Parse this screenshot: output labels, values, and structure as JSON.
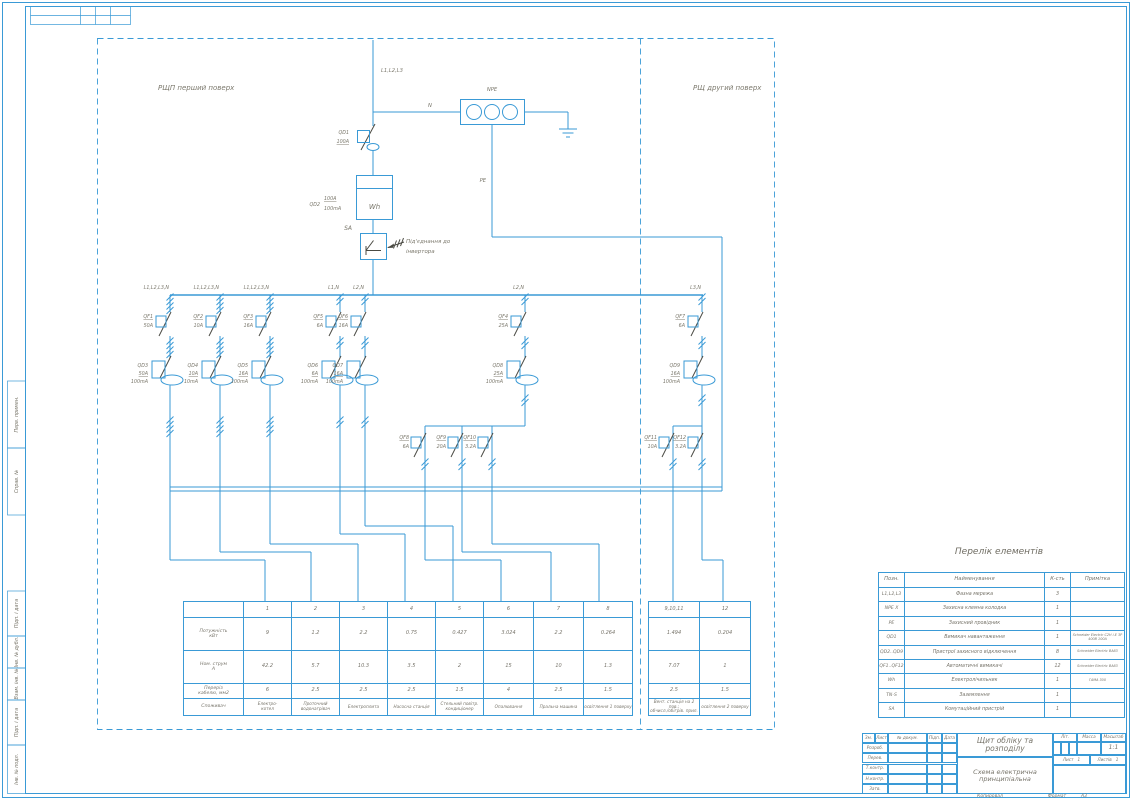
{
  "page": {
    "accent_color": "#3a9ad6",
    "symbol_color": "#4a4a43",
    "label_color": "#7b786c"
  },
  "frame": {
    "copied_label": "Копировал",
    "format_label": "Формат",
    "format_value": "А3",
    "left_stamps": [
      "Перв. примен.",
      "Справ. №",
      "Підп. і дата",
      "Інв. № дубл.",
      "Взам. інв. №",
      "Підп. і дата",
      "Інв. № подл."
    ]
  },
  "panels": {
    "first": "РЩП перший поверх",
    "second": "РЩ другий поверх"
  },
  "incoming": {
    "phase": "L1,L2,L3",
    "neutral": "N",
    "npe": "NPE",
    "pe": "PE",
    "qd1_name": "QD1",
    "qd1_rating": "100A",
    "meter_name": "QD2",
    "meter_rating": "100A",
    "meter_leak": "100mA",
    "meter_symbol": "Wh",
    "sa_name": "SA",
    "inverter_note_1": "Під'єднання до",
    "inverter_note_2": "інвертора"
  },
  "branches": [
    {
      "feed": "L1,L2,L3,N",
      "qf": "QF1",
      "qf_a": "50A",
      "qd": "QD3",
      "qd_a": "50A",
      "qd_ma": "100mA"
    },
    {
      "feed": "L1,L2,L3,N",
      "qf": "QF2",
      "qf_a": "10A",
      "qd": "QD4",
      "qd_a": "10A",
      "qd_ma": "10mA"
    },
    {
      "feed": "L1,L2,L3,N",
      "qf": "QF3",
      "qf_a": "16A",
      "qd": "QD5",
      "qd_a": "16A",
      "qd_ma": "100mA"
    },
    {
      "feed": "L1,N",
      "qf": "QF5",
      "qf_a": "6A",
      "qd": "QD6",
      "qd_a": "6A",
      "qd_ma": "100mA"
    },
    {
      "feed": "L2,N",
      "qf": "QF6",
      "qf_a": "16A",
      "qd": "QD7",
      "qd_a": "16A",
      "qd_ma": "100mA"
    },
    {
      "feed": "L2,N",
      "qf": "QF4",
      "qf_a": "25A",
      "qd": "QD8",
      "qd_a": "25A",
      "qd_ma": "100mA",
      "subs": [
        {
          "qf": "QF8",
          "qf_a": "6A"
        },
        {
          "qf": "QF9",
          "qf_a": "20A"
        },
        {
          "qf": "QF10",
          "qf_a": "3.2A"
        }
      ]
    },
    {
      "feed": "L3,N",
      "qf": "QF7",
      "qf_a": "6A",
      "qd": "QD9",
      "qd_a": "16A",
      "qd_ma": "100mA",
      "subs": [
        {
          "qf": "QF11",
          "qf_a": "10A"
        },
        {
          "qf": "QF12",
          "qf_a": "3.2A"
        }
      ]
    }
  ],
  "load_table": {
    "row_labels": [
      "Потужність\nкВт",
      "Ном. струм\nА",
      "Переріз\nкабелю, мм2",
      "Споживач"
    ],
    "columns": [
      {
        "num": "1",
        "power": "9",
        "current": "42.2",
        "cable": "6",
        "consumer": "Електро-\nкотел"
      },
      {
        "num": "2",
        "power": "1.2",
        "current": "5.7",
        "cable": "2.5",
        "consumer": "Проточний водонагрівач"
      },
      {
        "num": "3",
        "power": "2.2",
        "current": "10.3",
        "cable": "2.5",
        "consumer": "Електроплита"
      },
      {
        "num": "4",
        "power": "0.75",
        "current": "3.5",
        "cable": "2.5",
        "consumer": "Насосна станція"
      },
      {
        "num": "5",
        "power": "0.427",
        "current": "2",
        "cable": "1.5",
        "consumer": "Стельний повітр.\nкондиціонер"
      },
      {
        "num": "6",
        "power": "3.024",
        "current": "15",
        "cable": "4",
        "consumer": "Опалювання"
      },
      {
        "num": "7",
        "power": "2.2",
        "current": "10",
        "cable": "2.5",
        "consumer": "Пральна машина"
      },
      {
        "num": "8",
        "power": "0.264",
        "current": "1.3",
        "cable": "1.5",
        "consumer": "освітлення 1 поверху"
      },
      {
        "num": "9,10,11",
        "power": "1.494",
        "current": "7.07",
        "cable": "2.5",
        "consumer": "Вент. станція на 2 пов.;\nобчисл./обігрів. прил."
      },
      {
        "num": "12",
        "power": "0.204",
        "current": "1",
        "cable": "1.5",
        "consumer": "освітлення 2 поверху"
      }
    ]
  },
  "elements_table": {
    "title": "Перелік елементів",
    "headers": [
      "Позн.",
      "Найменування",
      "К-сть",
      "Примітка"
    ],
    "rows": [
      {
        "pos": "L1,L2,L3",
        "name": "Фазна мережа",
        "qty": "3",
        "note": ""
      },
      {
        "pos": "NPE X",
        "name": "Захисна клемна колодка",
        "qty": "1",
        "note": ""
      },
      {
        "pos": "PE",
        "name": "Захисний провідник",
        "qty": "1",
        "note": ""
      },
      {
        "pos": "QD1",
        "name": "Вимикач навантаження",
        "qty": "1",
        "note": "Schneider Electric C2H i-E 3P 400B 100A"
      },
      {
        "pos": "QD2..QD9",
        "name": "Пристрої захисного відключення",
        "qty": "8",
        "note": "Schneider Electric BA63"
      },
      {
        "pos": "QF1..QF12",
        "name": "Автоматичні вимикачі",
        "qty": "12",
        "note": "Schneider Electric BA63"
      },
      {
        "pos": "Wh",
        "name": "Електролічильник",
        "qty": "1",
        "note": "ГАМА 300"
      },
      {
        "pos": "TN-S",
        "name": "Заземлення",
        "qty": "1",
        "note": ""
      },
      {
        "pos": "SA",
        "name": "Комутаційний пристрій",
        "qty": "1",
        "note": ""
      }
    ]
  },
  "title_block": {
    "title": "Щит обліку та розподілу",
    "subtitle": "Схема електрична принципіальна",
    "sign_cols": [
      "Зм.",
      "Лист",
      "№ докум.",
      "Підп.",
      "Дата"
    ],
    "sign_rows": [
      "Розроб.",
      "Перев.",
      "Т.контр.",
      "Н.контр.",
      "Затв."
    ],
    "lit_label": "Літ.",
    "mass_label": "Масса",
    "scale_label": "Масштаб",
    "scale_value": "1:1",
    "sheet_label": "Лист",
    "sheet_value": "1",
    "sheets_label": "Листів",
    "sheets_value": "1"
  }
}
